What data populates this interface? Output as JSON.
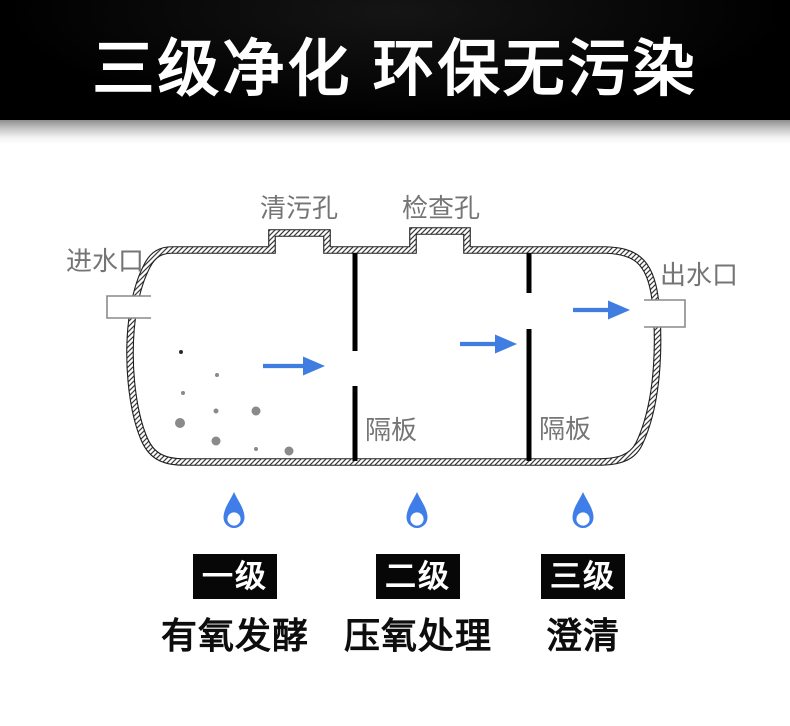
{
  "header": {
    "title": "三级净化 环保无污染"
  },
  "diagram": {
    "inlet_label": "进水口",
    "outlet_label": "出水口",
    "cleaning_hole_label": "清污孔",
    "inspection_hole_label": "检查孔",
    "baffle_label_1": "隔板",
    "baffle_label_2": "隔板",
    "icons": {
      "flow_arrow": "→",
      "water_drop": "💧"
    },
    "colors": {
      "arrow_blue": "#3f7de0",
      "droplet_blue": "#3f7de8",
      "label_gray": "#757575",
      "particle_gray": "#8a8a8a",
      "wall_ink": "#1f1f1f",
      "header_bg": "#000000",
      "header_text": "#ffffff"
    }
  },
  "stages": [
    {
      "badge": "一级",
      "description": "有氧发酵"
    },
    {
      "badge": "二级",
      "description": "压氧处理"
    },
    {
      "badge": "三级",
      "description": "澄清"
    }
  ]
}
